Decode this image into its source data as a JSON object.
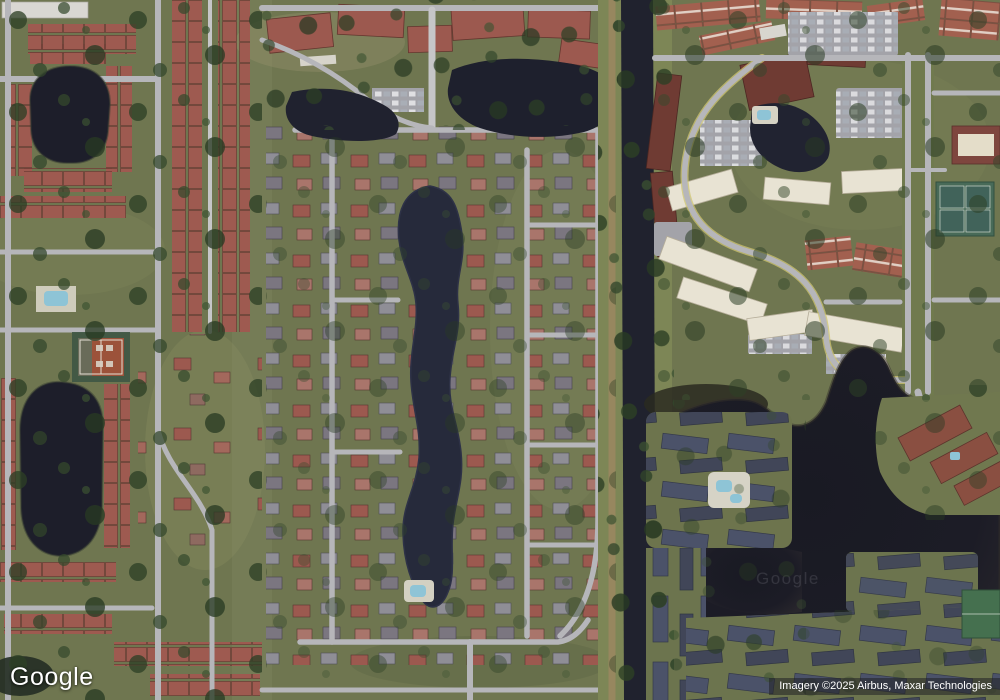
{
  "branding": {
    "logo_text": "Google",
    "lake_watermark": "Google"
  },
  "attribution": {
    "imagery_credit": "Imagery ©2025 Airbus, Maxar Technologies"
  },
  "colors": {
    "land": "#6f7650",
    "land_light": "#8d9165",
    "water": "#1d1e2a",
    "water_pond": "#262a3b",
    "water_dark": "#16171f",
    "canal": "#20222e",
    "road": "#b6b6ba",
    "road_lane": "#c6c6c8",
    "roof_red": "#9c594f",
    "roof_terracotta": "#a2604f",
    "roof_maroon": "#6f3b33",
    "roof_slate": "#49506a",
    "roof_cream": "#e8e3d3",
    "roof_white": "#d9d7d2",
    "tree": "#2c3f25",
    "parking": "#a3a3a9",
    "tennis_clay": "#9c523a",
    "pool": "#8ec4d6",
    "path_tan": "#97875f",
    "attribution_bg": "rgba(32,32,36,0.55)",
    "attribution_text": "#ffffff"
  }
}
